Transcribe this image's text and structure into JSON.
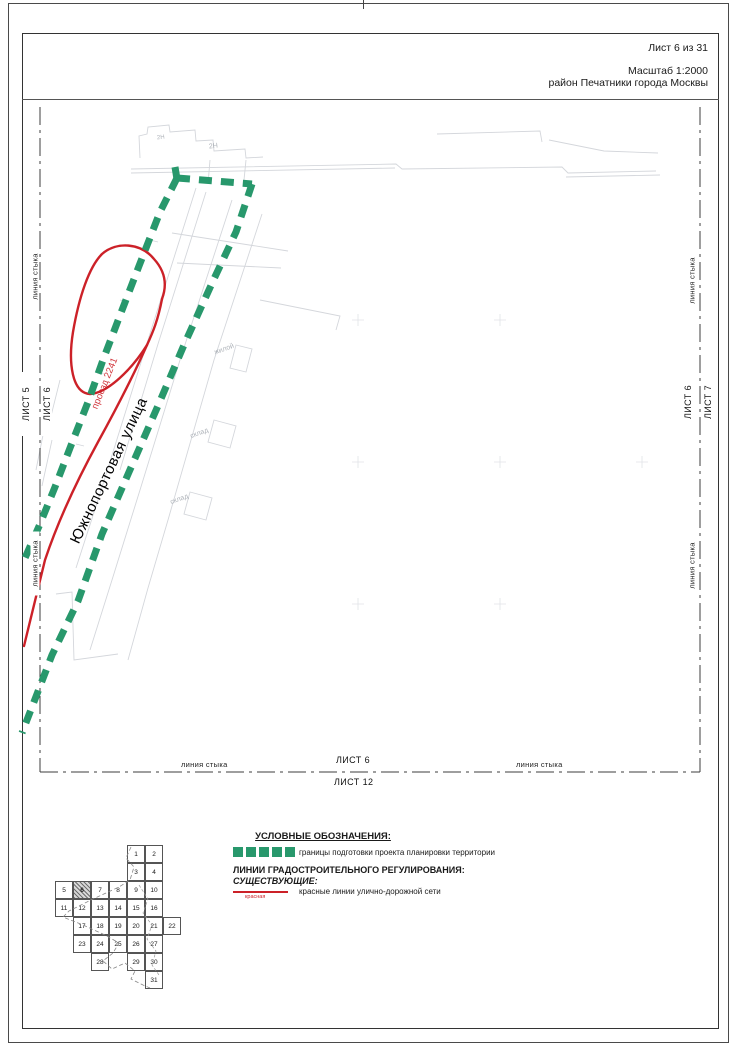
{
  "page": {
    "sheet_info": "Лист 6 из 31",
    "scale": "Масштаб 1:2000",
    "district": "район Печатники города Москвы"
  },
  "map": {
    "street_label": "Южнопортовая улица",
    "road_label": "проезд 2241",
    "junction_label": "линия стыка",
    "edges": {
      "left_sheet_a": "ЛИСТ 5",
      "left_sheet_b": "ЛИСТ 6",
      "right_sheet_a": "ЛИСТ 6",
      "right_sheet_b": "ЛИСТ 7",
      "bottom_sheet_a": "ЛИСТ 6",
      "bottom_sheet_b": "ЛИСТ 12"
    },
    "background_labels": [
      {
        "text": "2Н",
        "x": 209,
        "y": 143,
        "rot": -6,
        "size": 7
      },
      {
        "text": "2Н",
        "x": 157,
        "y": 135,
        "rot": -6,
        "size": 6
      },
      {
        "text": "жилой",
        "x": 214,
        "y": 346,
        "rot": -20,
        "size": 7
      },
      {
        "text": "склад",
        "x": 190,
        "y": 430,
        "rot": -20,
        "size": 7
      },
      {
        "text": "склад",
        "x": 170,
        "y": 496,
        "rot": -20,
        "size": 7
      }
    ],
    "colors": {
      "boundary_green": "#28986c",
      "red_line": "#cc2128"
    }
  },
  "legend": {
    "title": "УСЛОВНЫЕ ОБОЗНАЧЕНИЯ:",
    "boundary_label": "границы подготовки проекта планировки территории",
    "section_title": "ЛИНИИ ГРАДОСТРОИТЕЛЬНОГО РЕГУЛИРОВАНИЯ:",
    "section_subtitle": "СУЩЕСТВУЮЩИЕ:",
    "red_line_label": "красные линии улично-дорожной сети",
    "red_line_caption": "красная"
  },
  "sheet_index": {
    "current_sheet": 6,
    "cells": [
      {
        "n": 1,
        "row": 0,
        "col": 4
      },
      {
        "n": 2,
        "row": 0,
        "col": 5
      },
      {
        "n": 3,
        "row": 1,
        "col": 4
      },
      {
        "n": 4,
        "row": 1,
        "col": 5
      },
      {
        "n": 5,
        "row": 2,
        "col": 0
      },
      {
        "n": 6,
        "row": 2,
        "col": 1
      },
      {
        "n": 7,
        "row": 2,
        "col": 2
      },
      {
        "n": 8,
        "row": 2,
        "col": 3
      },
      {
        "n": 9,
        "row": 2,
        "col": 4
      },
      {
        "n": 10,
        "row": 2,
        "col": 5
      },
      {
        "n": 11,
        "row": 3,
        "col": 0
      },
      {
        "n": 12,
        "row": 3,
        "col": 1
      },
      {
        "n": 13,
        "row": 3,
        "col": 2
      },
      {
        "n": 14,
        "row": 3,
        "col": 3
      },
      {
        "n": 15,
        "row": 3,
        "col": 4
      },
      {
        "n": 16,
        "row": 3,
        "col": 5
      },
      {
        "n": 17,
        "row": 4,
        "col": 1
      },
      {
        "n": 18,
        "row": 4,
        "col": 2
      },
      {
        "n": 19,
        "row": 4,
        "col": 3
      },
      {
        "n": 20,
        "row": 4,
        "col": 4
      },
      {
        "n": 21,
        "row": 4,
        "col": 5
      },
      {
        "n": 22,
        "row": 4,
        "col": 6
      },
      {
        "n": 23,
        "row": 5,
        "col": 1
      },
      {
        "n": 24,
        "row": 5,
        "col": 2
      },
      {
        "n": 25,
        "row": 5,
        "col": 3
      },
      {
        "n": 26,
        "row": 5,
        "col": 4
      },
      {
        "n": 27,
        "row": 5,
        "col": 5
      },
      {
        "n": 28,
        "row": 6,
        "col": 2
      },
      {
        "n": 29,
        "row": 6,
        "col": 4
      },
      {
        "n": 30,
        "row": 6,
        "col": 5
      },
      {
        "n": 31,
        "row": 7,
        "col": 5
      }
    ]
  }
}
